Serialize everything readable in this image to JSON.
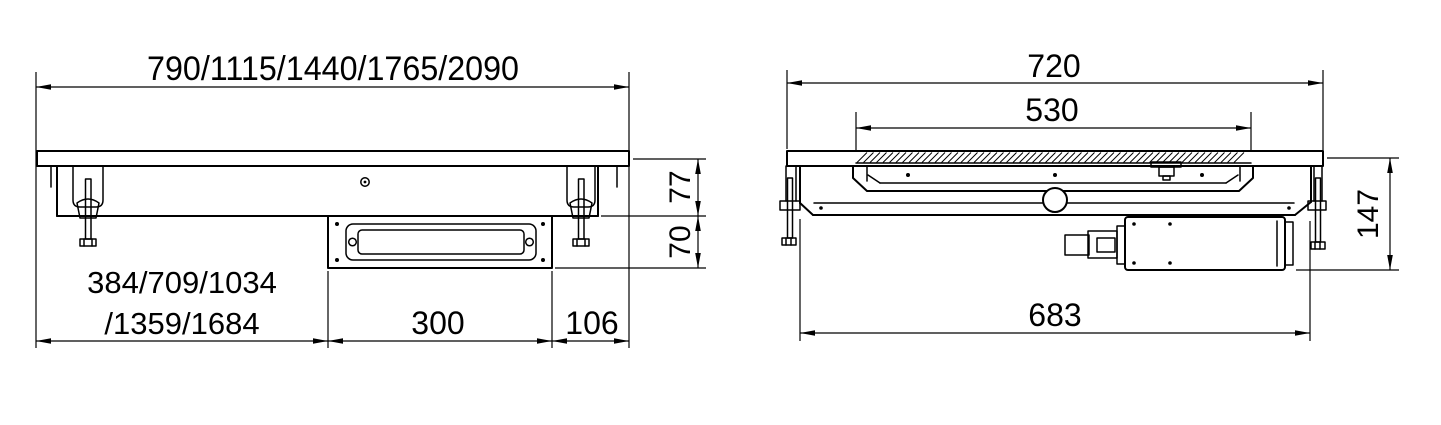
{
  "front": {
    "dim_top": "790/1115/1440/1765/2090",
    "dim_bottom_left_line1": "384/709/1034",
    "dim_bottom_left_line2": "/1359/1684",
    "dim_box": "300",
    "dim_overhang": "106",
    "dim_depth_top": "77",
    "dim_depth_bottom": "70"
  },
  "side": {
    "dim_top": "720",
    "dim_cutout": "530",
    "dim_bottom": "683",
    "dim_height": "147"
  },
  "colors": {
    "line": "#000000",
    "background": "#ffffff"
  }
}
